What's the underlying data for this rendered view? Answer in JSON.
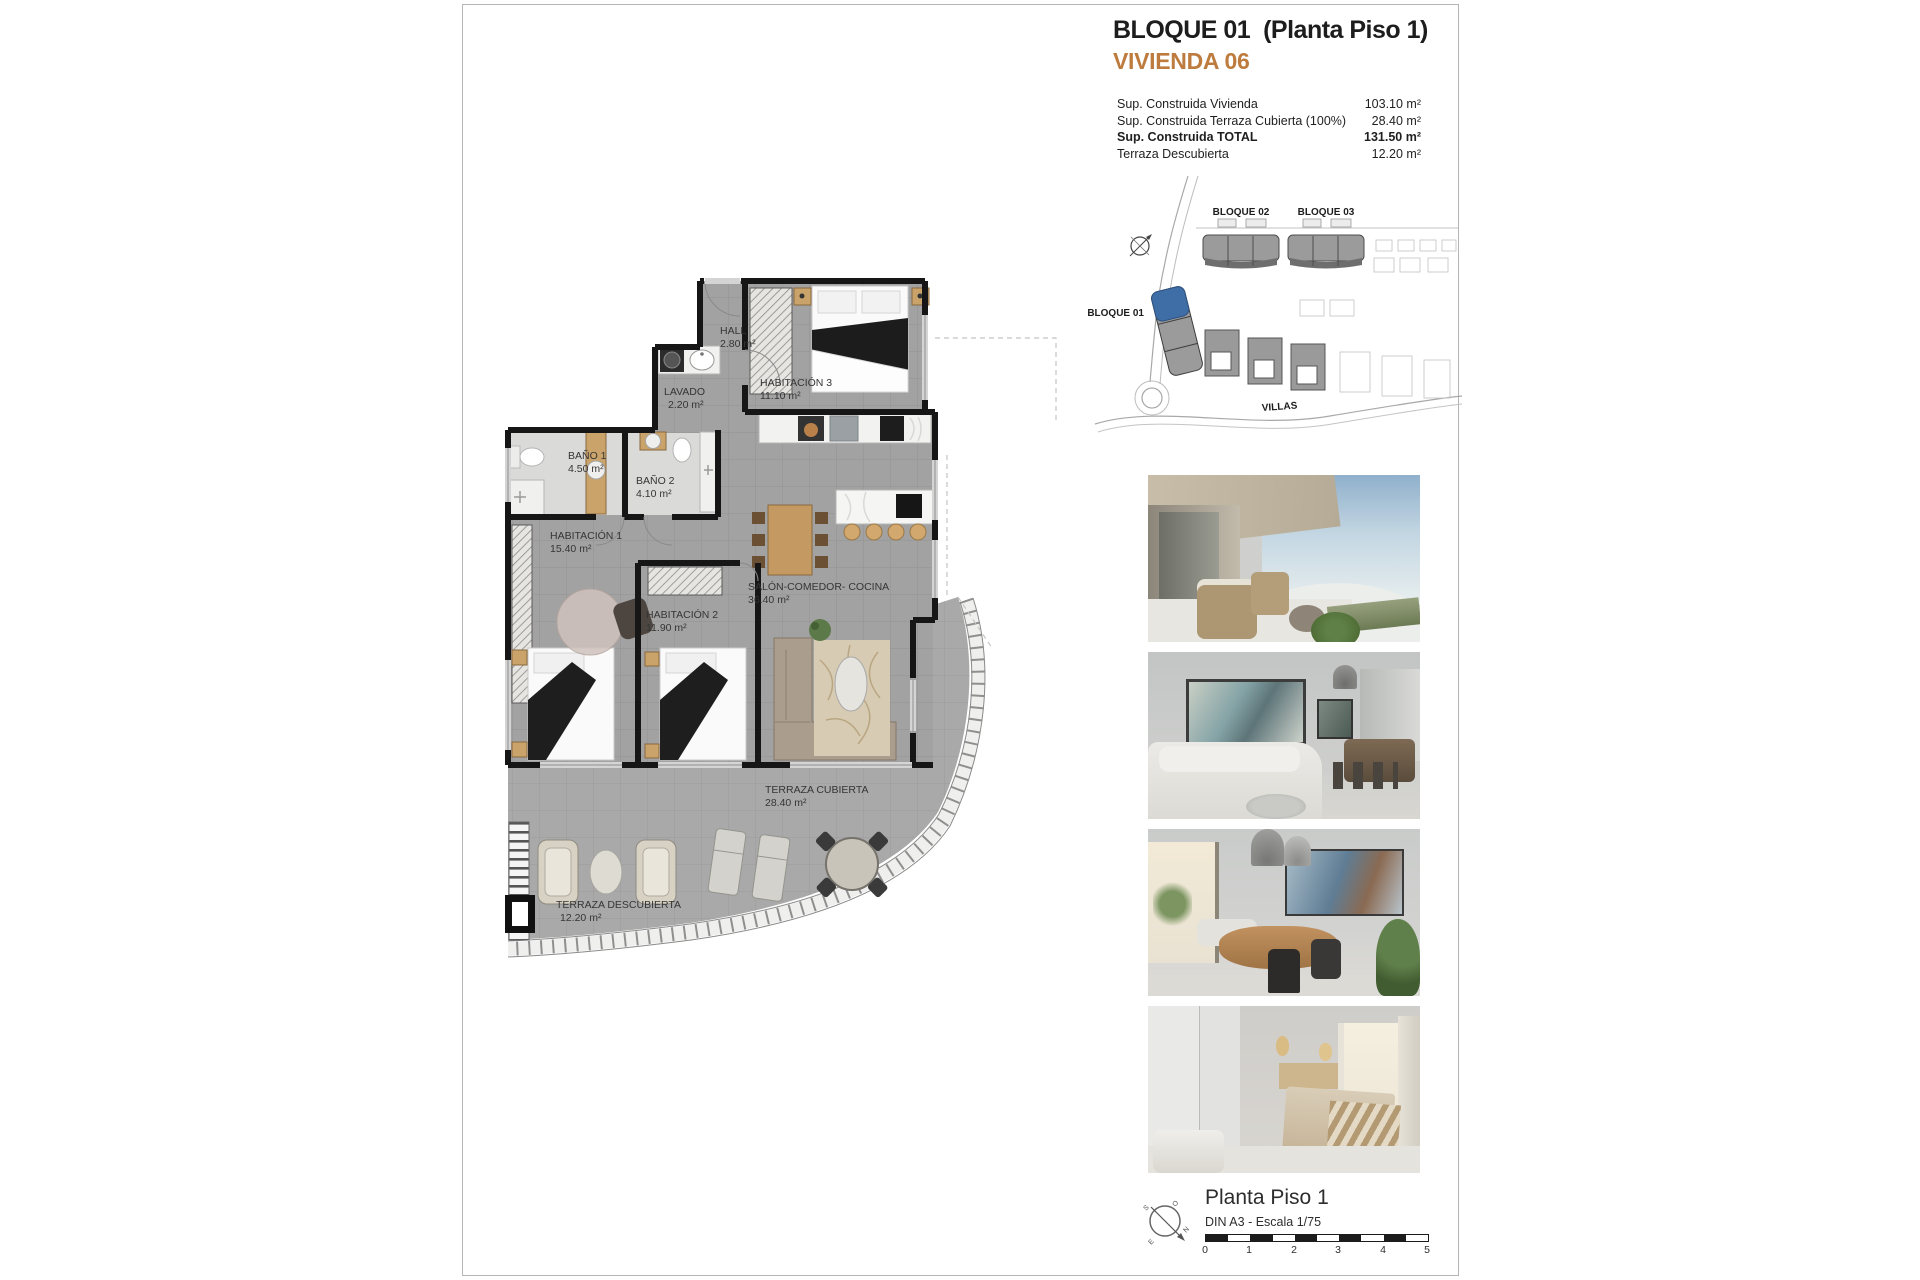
{
  "header": {
    "title": "BLOQUE 01  (Planta Piso 1)",
    "subtitle": "VIVIENDA 06",
    "accent_color": "#bd7b3d"
  },
  "area_table": {
    "rows": [
      {
        "label": "Sup. Construida Vivienda",
        "value": "103.10 m²"
      },
      {
        "label": "Sup. Construida Terraza Cubierta (100%)",
        "value": "28.40 m²"
      },
      {
        "label": "Sup. Construida TOTAL",
        "value": "131.50 m²"
      },
      {
        "label": "Terraza Descubierta",
        "value": "12.20 m²"
      }
    ]
  },
  "site_plan": {
    "bloque01": "BLOQUE 01",
    "bloque02": "BLOQUE 02",
    "bloque03": "BLOQUE 03",
    "villas": "VILLAS",
    "highlight_color": "#3f6ea6"
  },
  "floor_plan": {
    "rooms": [
      {
        "name": "HALL",
        "area": "2.80 m²"
      },
      {
        "name": "LAVADO",
        "area": "2.20 m²"
      },
      {
        "name": "HABITACIÓN 3",
        "area": "11.10 m²"
      },
      {
        "name": "BAÑO 1",
        "area": "4.50 m²"
      },
      {
        "name": "BAÑO 2",
        "area": "4.10 m²"
      },
      {
        "name": "HABITACIÓN 1",
        "area": "15.40 m²"
      },
      {
        "name": "HABITACIÓN 2",
        "area": "11.90 m²"
      },
      {
        "name": "SALÓN-COMEDOR- COCINA",
        "area": "36.40 m²"
      },
      {
        "name": "TERRAZA CUBIERTA",
        "area": "28.40 m²"
      },
      {
        "name": "TERRAZA DESCUBIERTA",
        "area": "12.20 m²"
      }
    ]
  },
  "footer": {
    "plan_name": "Planta Piso 1",
    "scale_note": "DIN A3 - Escala 1/75",
    "scale_ticks": [
      "0",
      "1",
      "2",
      "3",
      "4",
      "5"
    ],
    "compass": {
      "n": "N",
      "s": "S",
      "e": "E",
      "o": "O"
    }
  }
}
